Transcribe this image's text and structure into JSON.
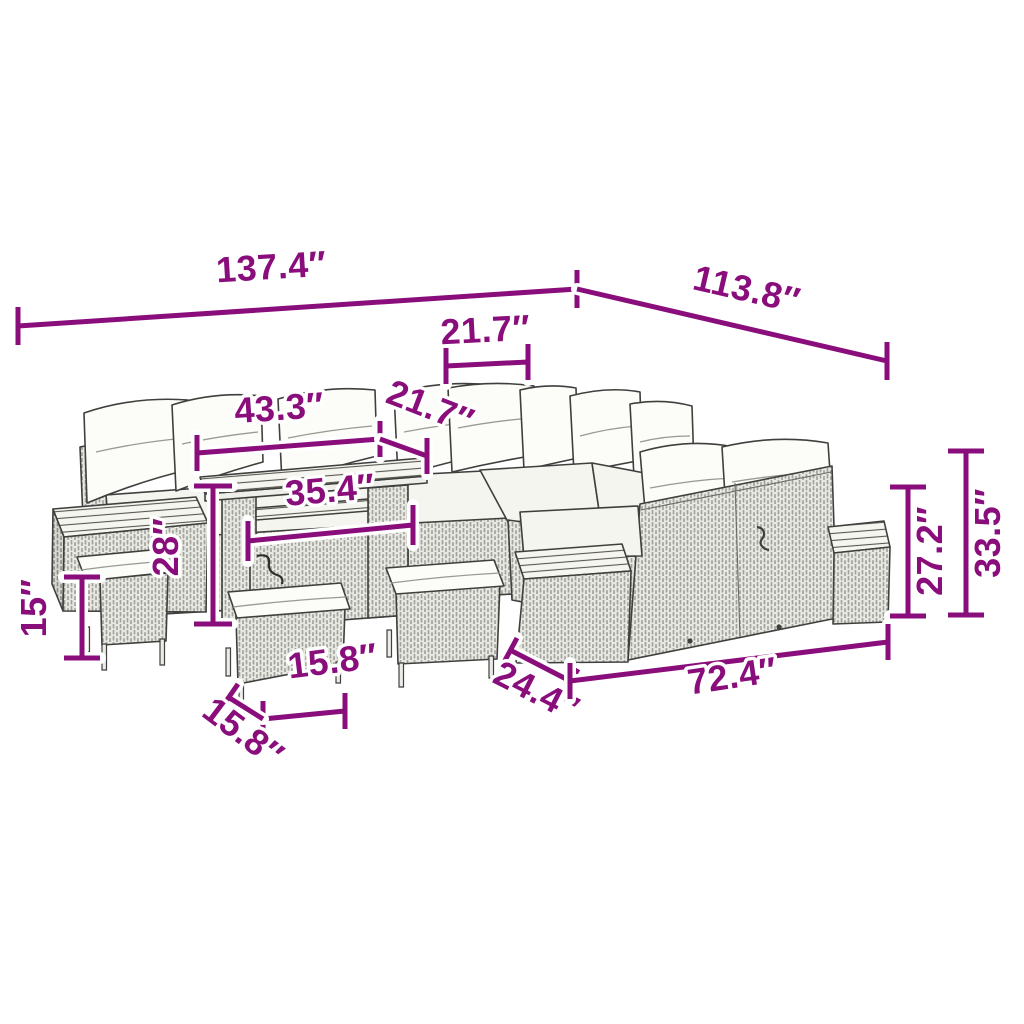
{
  "diagram": {
    "type": "product-dimension-diagram",
    "subject": "rattan-garden-lounge-set",
    "unit": "inches",
    "accent_color": "#8a0d7c",
    "line_art_color": "#3f3f3d",
    "background_color": "#ffffff",
    "dims": {
      "overall_width": "137.4″",
      "overall_depth": "113.8″",
      "seat_width": "21.7″",
      "seat_depth": "21.7″",
      "table_length": "43.3″",
      "table_shelf_width": "35.4″",
      "table_height": "28″",
      "stool_height": "15″",
      "stool_width": "15.8″",
      "stool_depth": "15.8″",
      "sofa_depth": "24.4″",
      "sofa_length": "72.4″",
      "backrest_height": "27.2″",
      "total_height": "33.5″"
    }
  }
}
